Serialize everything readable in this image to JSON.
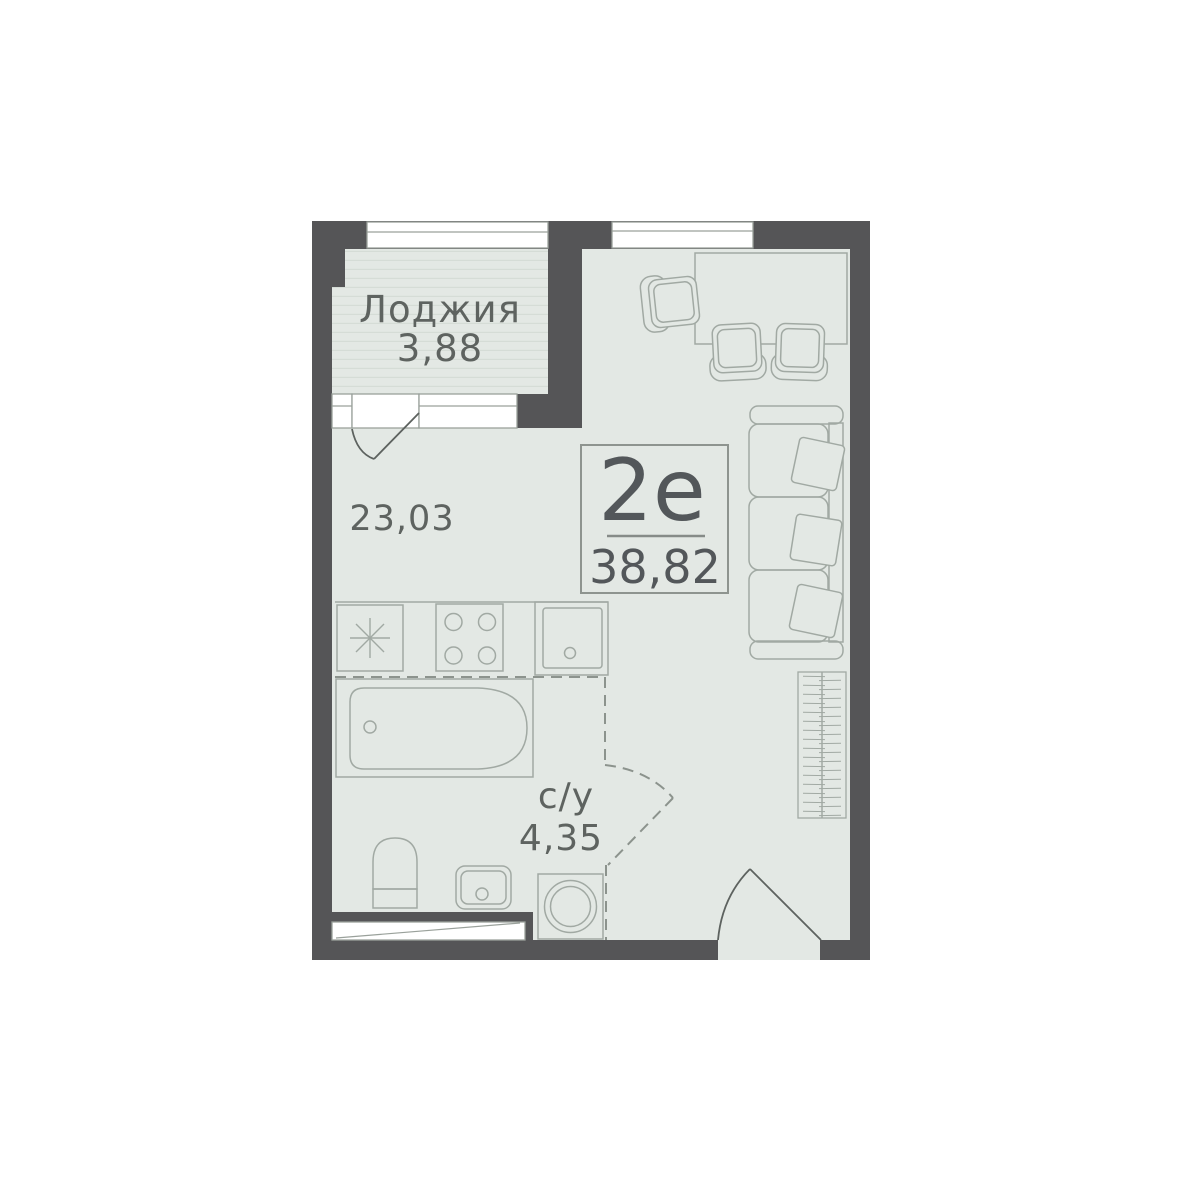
{
  "plan": {
    "title": "Studio apartment floor plan",
    "unit": {
      "type": "2е",
      "total_area": "38,82"
    },
    "loggia": {
      "name": "Лоджия",
      "area": "3,88"
    },
    "living": {
      "area": "23,03"
    },
    "bathroom": {
      "name": "с/у",
      "area": "4,35"
    },
    "rooms": [
      {
        "name": "Лоджия",
        "area_m2": "3,88"
      },
      {
        "name": "жилая зона",
        "area_m2": "23,03"
      },
      {
        "name": "с/у",
        "area_m2": "4,35"
      }
    ]
  },
  "colors": {
    "wall": "#555557",
    "floor": "#e3e8e4",
    "floor_stripe": "#d5dcd6",
    "furniture_line": "#a1a9a3",
    "door_line": "#5d625f",
    "dashed_partition": "#8c938d",
    "window_frame": "#9aa19b",
    "label_text": "#5e6360",
    "unit_text": "#53575a",
    "background": "#ffffff"
  },
  "icons": {
    "fridge": "snowflake-asterisk",
    "stove": "four-burners",
    "sink_kitchen": "basin-with-drain",
    "bathtub": "tub-outline",
    "toilet": "toilet-outline",
    "sink_bath": "basin-with-drain",
    "washing_machine": "drum-circles",
    "wardrobe": "hatched-rect",
    "sofa": "three-seat-with-pillows",
    "dining": "table-with-three-chairs"
  }
}
